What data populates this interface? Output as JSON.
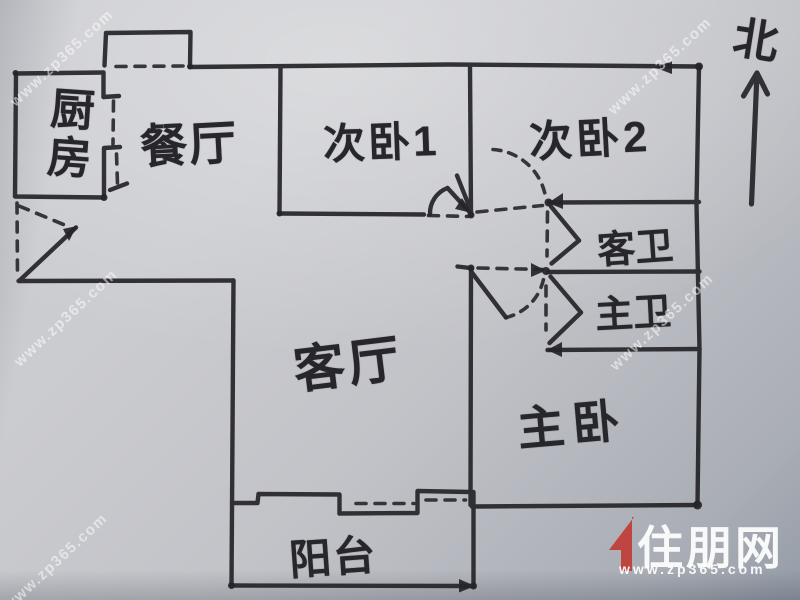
{
  "compass": {
    "label": "北"
  },
  "rooms": {
    "kitchen": {
      "label": "厨房"
    },
    "dining": {
      "label": "餐厅"
    },
    "bedroom1": {
      "label": "次卧1"
    },
    "bedroom2": {
      "label": "次卧2"
    },
    "guest_bath": {
      "label": "客卫"
    },
    "master_bath": {
      "label": "主卫"
    },
    "living": {
      "label": "客厅"
    },
    "master_bedroom": {
      "label": "主卧"
    },
    "balcony": {
      "label": "阳台"
    }
  },
  "watermark": {
    "text": "www.zp365.com"
  },
  "logo": {
    "brand": "住朋网",
    "url": "www.zp365.com"
  },
  "colors": {
    "ink": "#26262a",
    "paper": "#c4c5ca",
    "logo_red": "#c2372f",
    "logo_text": "#ffffff",
    "watermark": "#ffffff"
  }
}
